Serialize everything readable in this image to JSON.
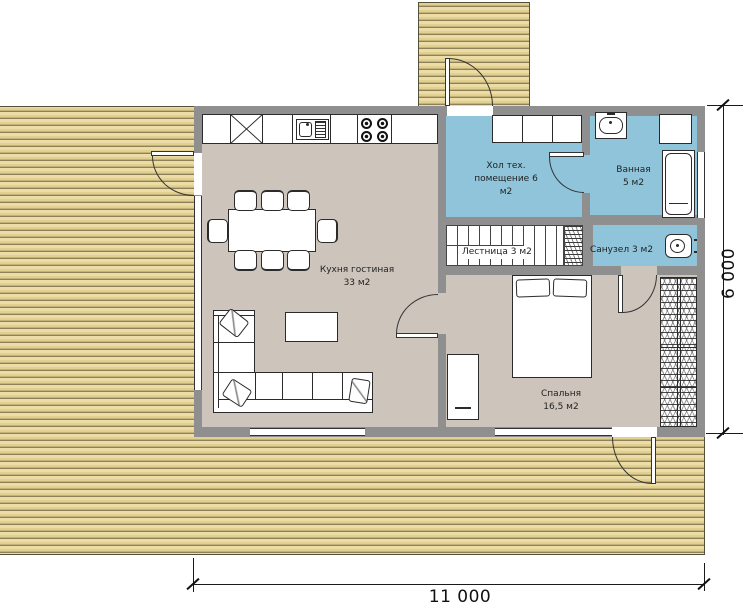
{
  "plan_type": "floor-plan",
  "rooms": {
    "kitchen_living": {
      "label": "Кухня гостиная\n33 м2"
    },
    "hall_tech": {
      "label": "Хол тех.\nпомещение 6\nм2"
    },
    "bathroom": {
      "label": "Ванная\n5 м2"
    },
    "stairs": {
      "label": "Лестница 3 м2"
    },
    "wc": {
      "label": "Санузел 3 м2"
    },
    "bedroom": {
      "label": "Спальня\n16,5 м2"
    }
  },
  "dimensions": {
    "width_label": "11 000",
    "height_label": "6 000"
  },
  "colors": {
    "deck_wood": "#e2d091",
    "wall_gray": "#8f8f8f",
    "floor_taupe": "#cdc5bc",
    "wet_room_blue": "#8fc4da",
    "outline": "#2b2b2b"
  }
}
